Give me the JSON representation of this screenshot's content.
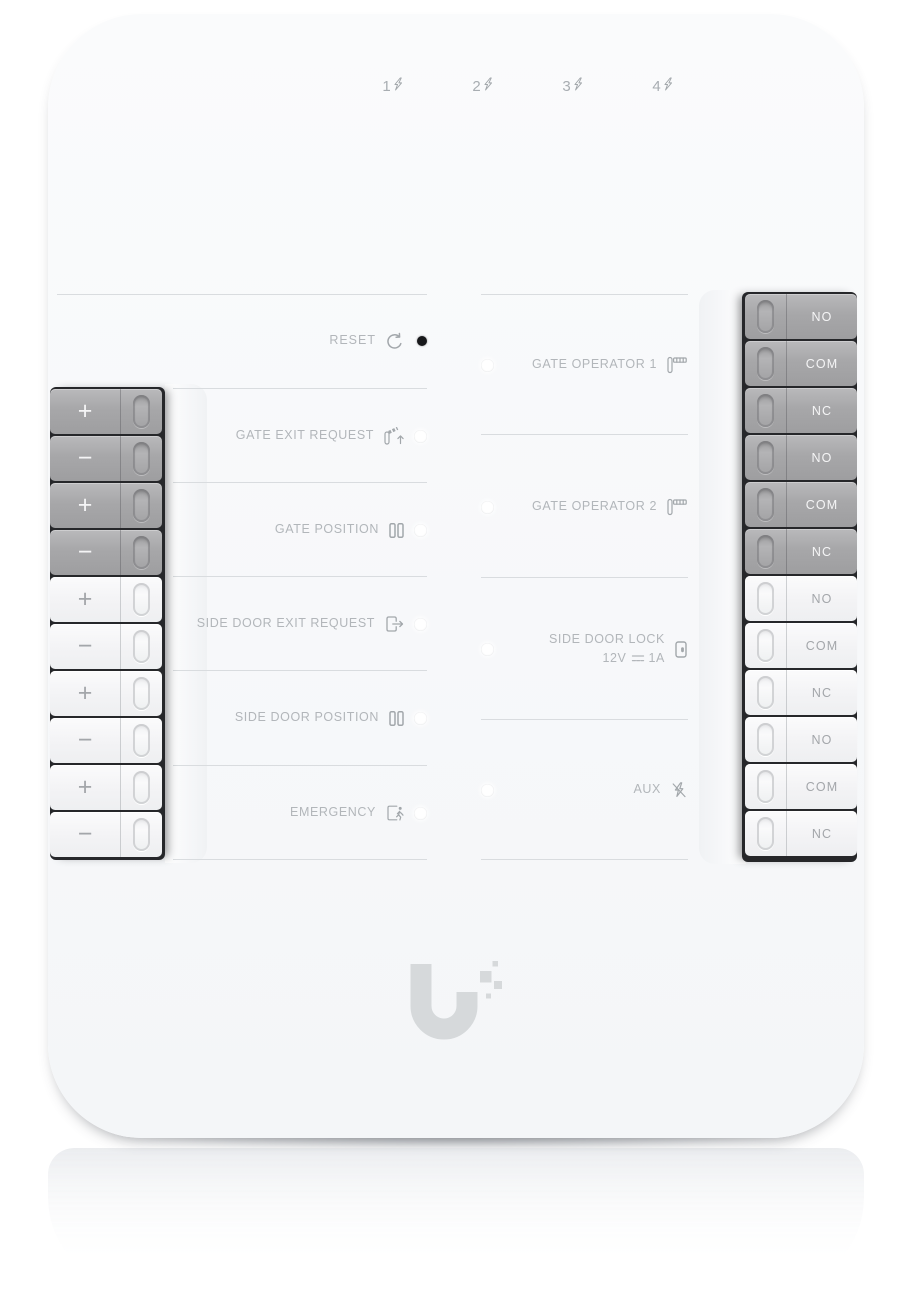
{
  "top_status": {
    "power": {
      "state": "on",
      "icon": "power-icon"
    },
    "channels": [
      {
        "label": "1",
        "icon": "lightning-icon"
      },
      {
        "label": "2",
        "icon": "lightning-icon"
      },
      {
        "label": "3",
        "icon": "lightning-icon"
      },
      {
        "label": "4",
        "icon": "lightning-icon"
      }
    ]
  },
  "reset": {
    "label": "RESET",
    "icon": "reset-icon"
  },
  "input_rows": [
    {
      "label": "GATE EXIT REQUEST",
      "icon": "gate-exit-request-icon"
    },
    {
      "label": "GATE POSITION",
      "icon": "gate-position-icon"
    },
    {
      "label": "SIDE DOOR EXIT REQUEST",
      "icon": "side-door-exit-request-icon"
    },
    {
      "label": "SIDE DOOR POSITION",
      "icon": "side-door-position-icon"
    },
    {
      "label": "EMERGENCY",
      "icon": "emergency-exit-icon"
    }
  ],
  "output_rows": [
    {
      "label": "GATE OPERATOR 1",
      "icon": "gate-operator-icon"
    },
    {
      "label": "GATE OPERATOR 2",
      "icon": "gate-operator-icon"
    },
    {
      "label": "SIDE DOOR LOCK",
      "rating_voltage": "12V",
      "rating_current": "1A",
      "icon": "door-lock-icon"
    },
    {
      "label": "AUX",
      "icon": "aux-no-power-icon"
    }
  ],
  "left_terminals": {
    "powered": [
      "+",
      "−",
      "+",
      "−"
    ],
    "dry": [
      "+",
      "−",
      "+",
      "−",
      "+",
      "−"
    ]
  },
  "right_terminals": {
    "powered": [
      "NO",
      "COM",
      "NC",
      "NO",
      "COM",
      "NC"
    ],
    "dry": [
      "NO",
      "COM",
      "NC",
      "NO",
      "COM",
      "NC"
    ]
  },
  "brand": {
    "logo": "ubiquiti-u-logo"
  },
  "colors": {
    "power_led_blue": "#2fb5e8",
    "panel": "#f8f9fa",
    "label_text": "#b2b6ba",
    "terminal_gray": "#a8a8aa",
    "terminal_light": "#f3f3f5",
    "divider_line": "#d9dcdf"
  }
}
